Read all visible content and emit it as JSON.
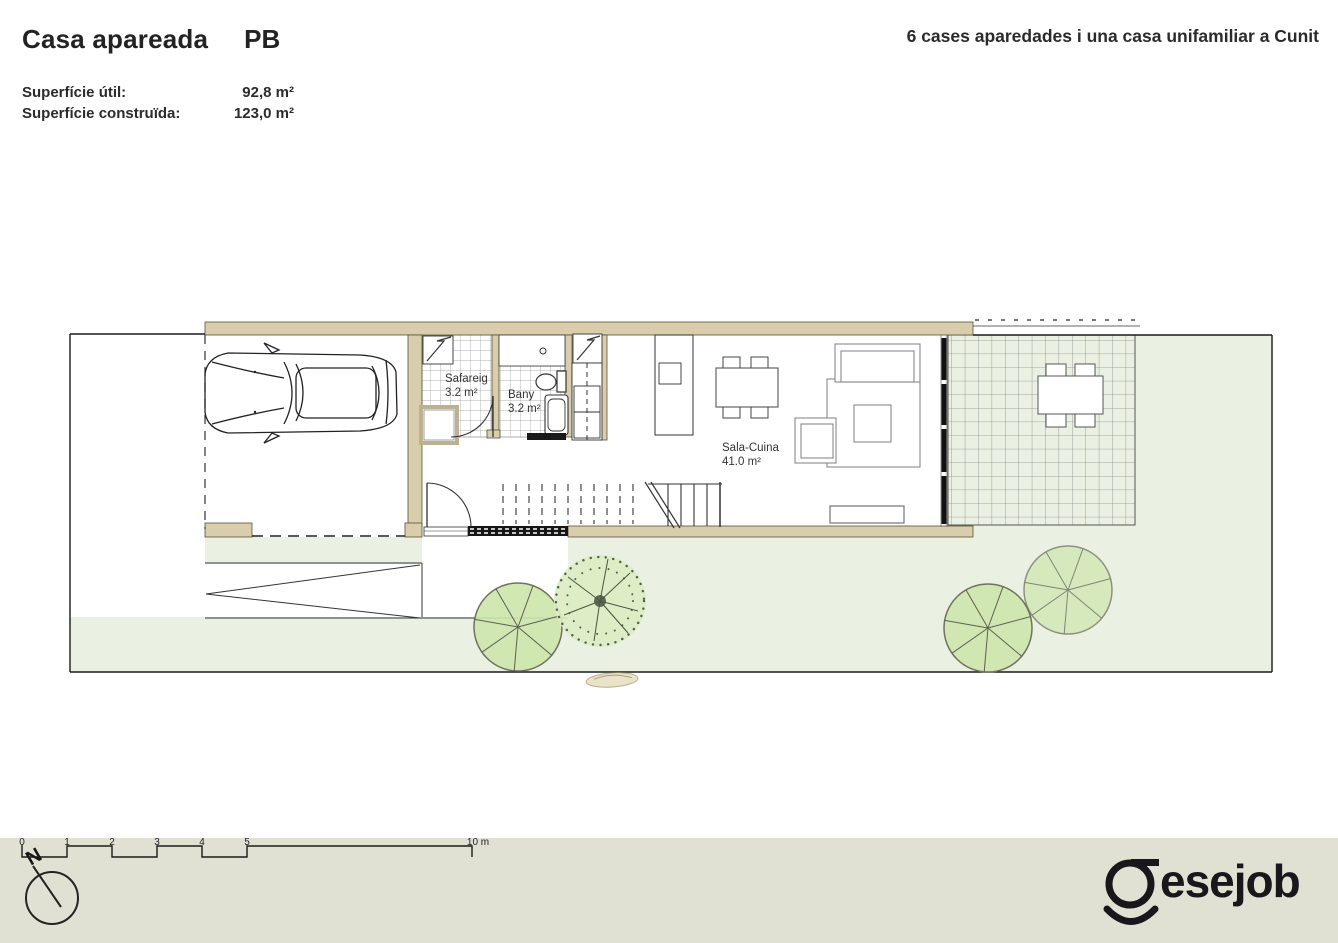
{
  "header": {
    "title": "Casa apareada",
    "floor_code": "PB",
    "stats": [
      {
        "label": "Superfície útil:",
        "value": "92,8 m²"
      },
      {
        "label": "Superfície construïda:",
        "value": "123,0 m²"
      }
    ],
    "project_title": "6 cases aparedades i una casa unifamiliar a Cunit"
  },
  "plan": {
    "rooms": [
      {
        "name": "Safareig",
        "area": "3.2 m²"
      },
      {
        "name": "Bany",
        "area": "3.2 m²"
      },
      {
        "name": "Sala-Cuina",
        "area": "41.0 m²"
      }
    ]
  },
  "scale_bar": {
    "ticks": [
      "0",
      "1",
      "2",
      "3",
      "4",
      "5"
    ],
    "end_label": "10 m"
  },
  "compass": {
    "label": "N"
  },
  "logo": {
    "text": "esejob"
  },
  "colors": {
    "wall_tan": "#d9cdab",
    "garden_green": "#eaf1e3",
    "footer_band": "#e1e1d3",
    "line_black": "#1a1a1a"
  }
}
